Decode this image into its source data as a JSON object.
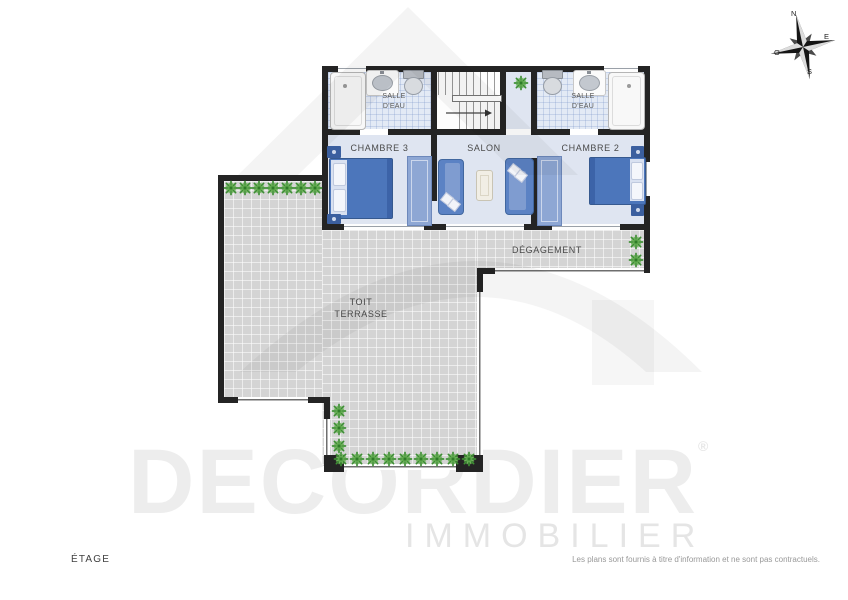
{
  "rooms": {
    "bath_left": {
      "l1": "SALLE",
      "l2": "D'EAU"
    },
    "bath_right": {
      "l1": "SALLE",
      "l2": "D'EAU"
    },
    "chambre3": {
      "label": "CHAMBRE 3"
    },
    "salon": {
      "label": "SALON"
    },
    "chambre2": {
      "label": "CHAMBRE 2"
    },
    "degagement": {
      "label": "DÉGAGEMENT"
    },
    "terrasse": {
      "l1": "TOIT",
      "l2": "TERRASSE"
    }
  },
  "compass": {
    "north": "N",
    "east": "E",
    "south": "S",
    "west": "O"
  },
  "watermark": {
    "brand": "DECORDIER",
    "registered": "®",
    "tagline": "IMMOBILIER"
  },
  "footer": {
    "floor_label": "ÉTAGE",
    "disclaimer": "Les plans sont fournis à titre d'information et ne sont pas contractuels."
  },
  "colors": {
    "wall": "#242424",
    "terrace_tile": "#d4d4d4",
    "bath_tile": "#e3eaf5",
    "room_floor": "#dfe5f1",
    "furniture_blue": "#5b82c4",
    "plant_green": "#3d8f33",
    "label_text": "#4a4a4a",
    "watermark_gray": "#ededed"
  }
}
